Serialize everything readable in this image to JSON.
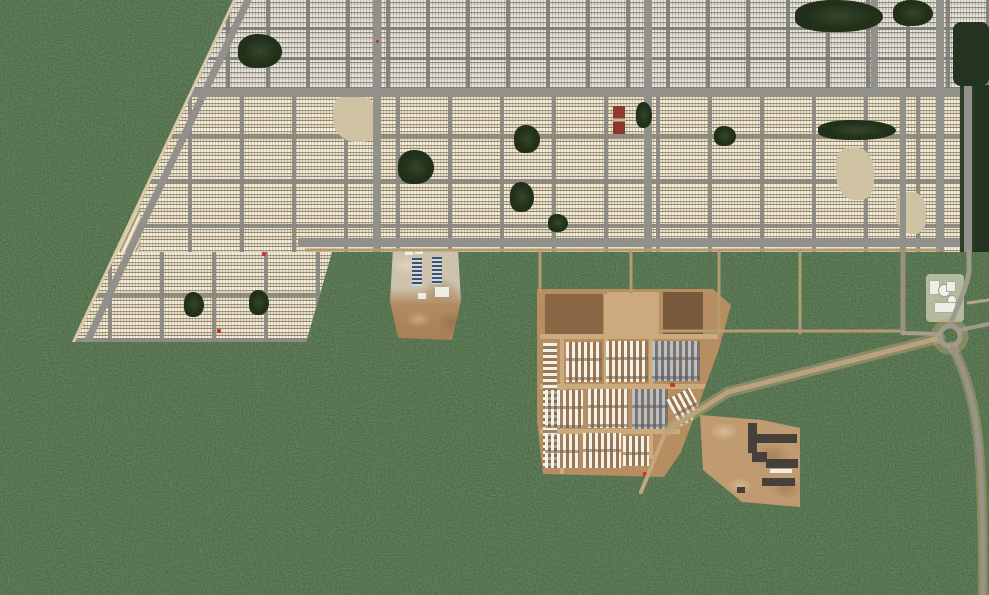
{
  "scene": {
    "type": "satellite_aerial_photo",
    "label": "Satellite view of a planned suburban housing development bordered by dense dark forest, with construction sites, dirt roads and a roundabout",
    "width_px": 989,
    "height_px": 595
  },
  "palette": {
    "forest_dark": "#1c2817",
    "forest_mid": "#26341f",
    "housing_ground_beige": "#c4b590",
    "housing_ground_gray": "#aaa79d",
    "house_roof_white": "#f3eedb",
    "street_gray": "#92908a",
    "dirt_road_tan": "#c2a77a",
    "construction_dirt": "#b98f63",
    "dirt_lot_dark": "#8a6644",
    "blue_roof": "#3f5168",
    "dark_warehouse_roof": "#46403a",
    "red_roof": "#8f3b2f",
    "tank_white": "#eff1ea"
  },
  "regions": {
    "forest": {
      "label": "Dense dark-green forest filling the west and south of the frame"
    },
    "housing": {
      "label": "Large grid-planned housing development of tightly packed white-roofed row houses",
      "upper_band": "Denser gray-toned block grid along the top edge",
      "mid_band": "Beige blocks filled with rows of white houses separated by gray streets",
      "west_wedge": "Triangular wedge of diagonal house rows along the forest edge",
      "tree_patches": 12,
      "red_roofed_building": 1
    },
    "main_road_horizontal": {
      "label": "East-west main road across the development"
    },
    "lower_boundary_road": {
      "label": "Road along the southern edge of the development"
    },
    "site_a": {
      "label": "Small construction site with two blue-roofed modular buildings and bare brown soil"
    },
    "site_b": {
      "label": "Large construction camp: dirt lots and many rows of white modular buildings"
    },
    "site_c": {
      "label": "Warehouse construction area with long dark-roofed sheds on cleared tan ground"
    },
    "utility_facility": {
      "label": "Small utility compound with white circular tanks near the roundabout"
    },
    "roundabout": {
      "label": "Traffic roundabout near the right edge connecting forest roads"
    },
    "forest_roads": {
      "label": "Grid of tan dirt roads cut through forest, a wide diagonal road to the camp and a curving road to the bottom-right corner"
    }
  }
}
